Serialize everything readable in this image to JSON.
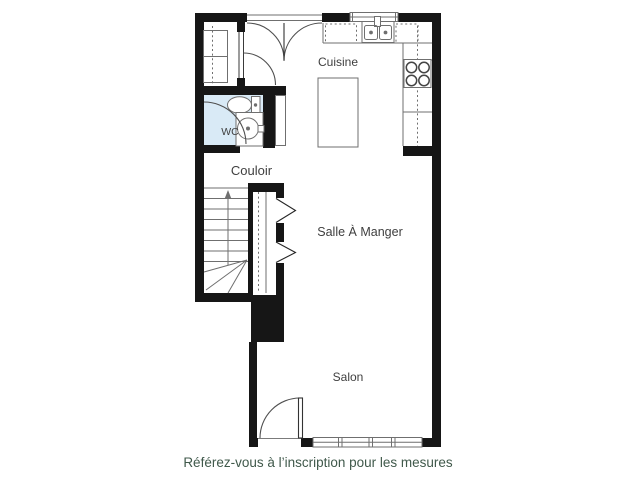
{
  "plan": {
    "rooms": [
      {
        "name": "Cuisine"
      },
      {
        "name": "WC"
      },
      {
        "name": "Couloir"
      },
      {
        "name": "Salle À Manger"
      },
      {
        "name": "Salon"
      }
    ],
    "caption": "Référez-vous à l’inscription pour les mesures",
    "icons": [
      "toilet-icon",
      "wc-sink-icon",
      "kitchen-sink-icon",
      "stove-icon",
      "kitchen-island-icon",
      "staircase-icon",
      "up-arrow-icon",
      "door-swing-arc-icon",
      "bifold-door-chevron-icon",
      "window-icon",
      "closet-shelves-icon"
    ],
    "colors": {
      "wall": "#161616",
      "fixture_outline": "#6f6f6f",
      "door_line": "#4f4f4f",
      "label": "#3f3f3f",
      "wc_floor": "#d9eaf6",
      "caption_text": "#40594b",
      "background": "#ffffff"
    }
  }
}
